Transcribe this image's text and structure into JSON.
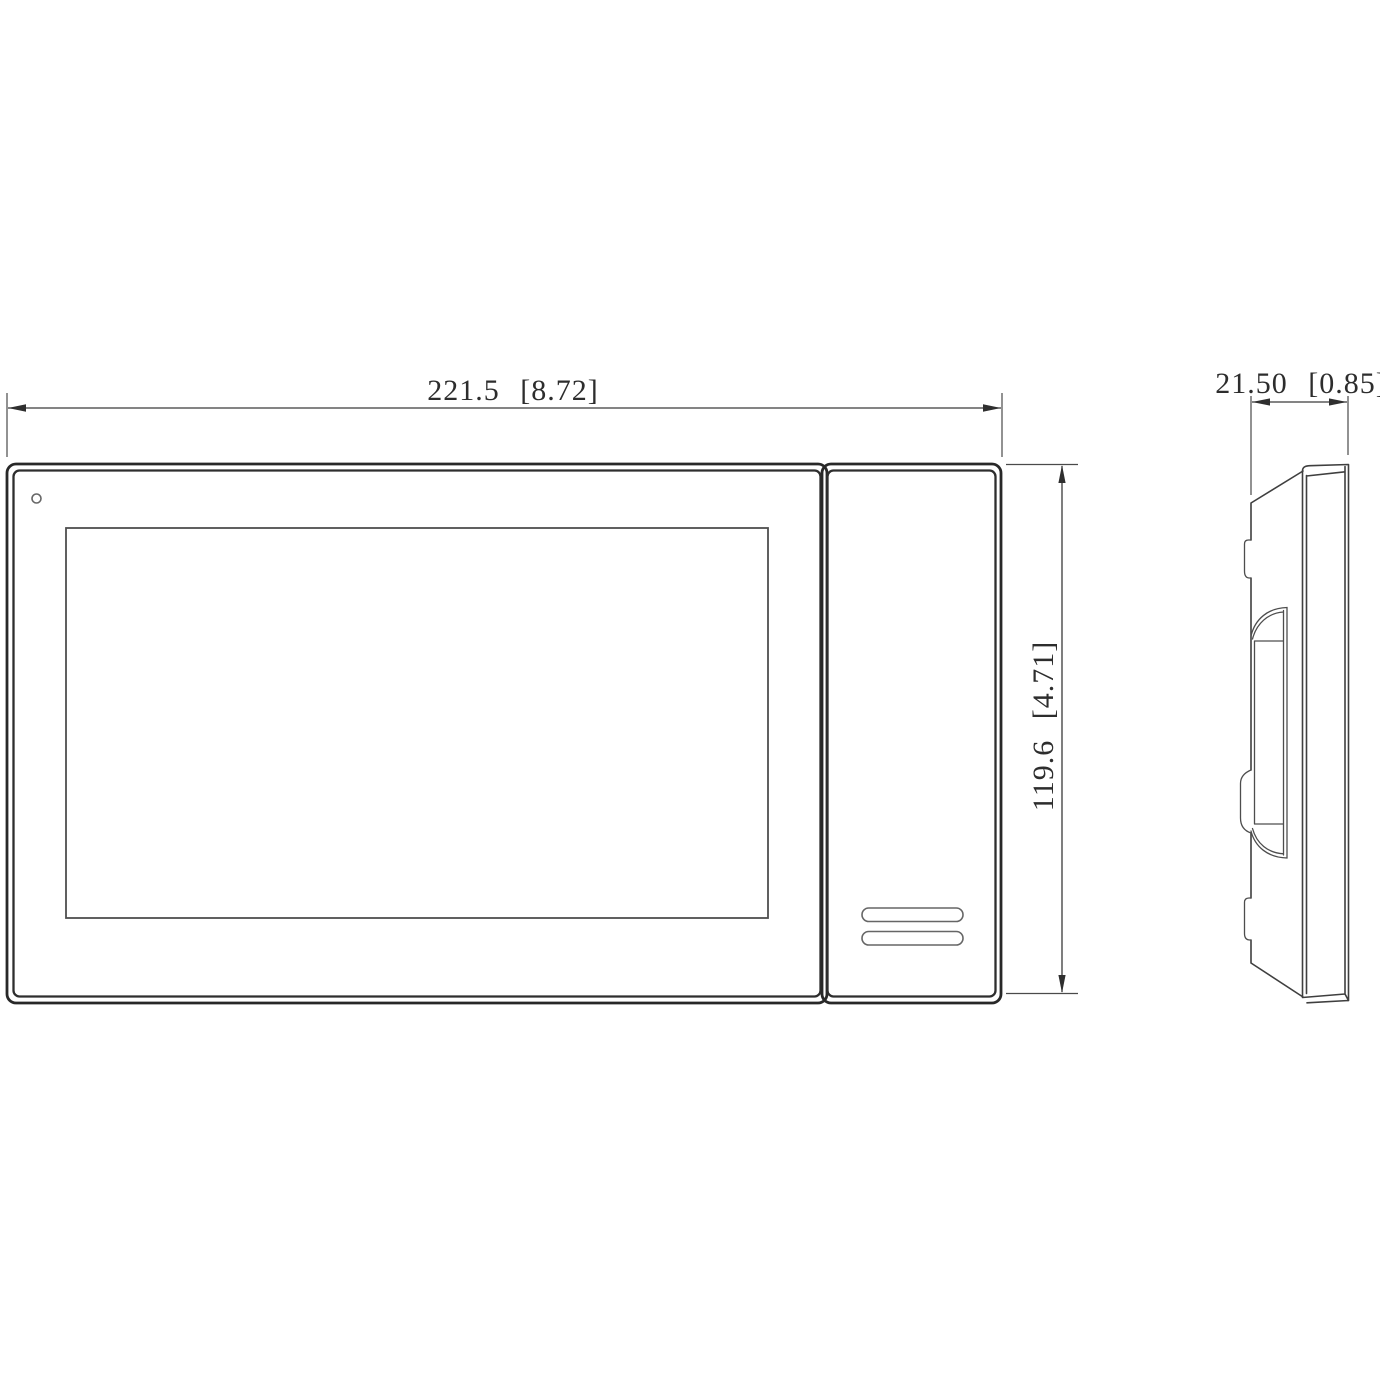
{
  "drawing": {
    "type": "technical-dimension-drawing",
    "views": {
      "front_view": "monitor front elevation",
      "side_view": "monitor side profile"
    },
    "dimensions": {
      "front_width": "221.5 [8.72]",
      "front_height": "119.6 [4.71]",
      "side_depth": "21.50 [0.85]"
    },
    "colors": {
      "background": "#ffffff",
      "outline_dark": "#282828",
      "line_medium": "#4a4a4a",
      "line_light": "#666666",
      "text": "#2d2d2d"
    }
  }
}
